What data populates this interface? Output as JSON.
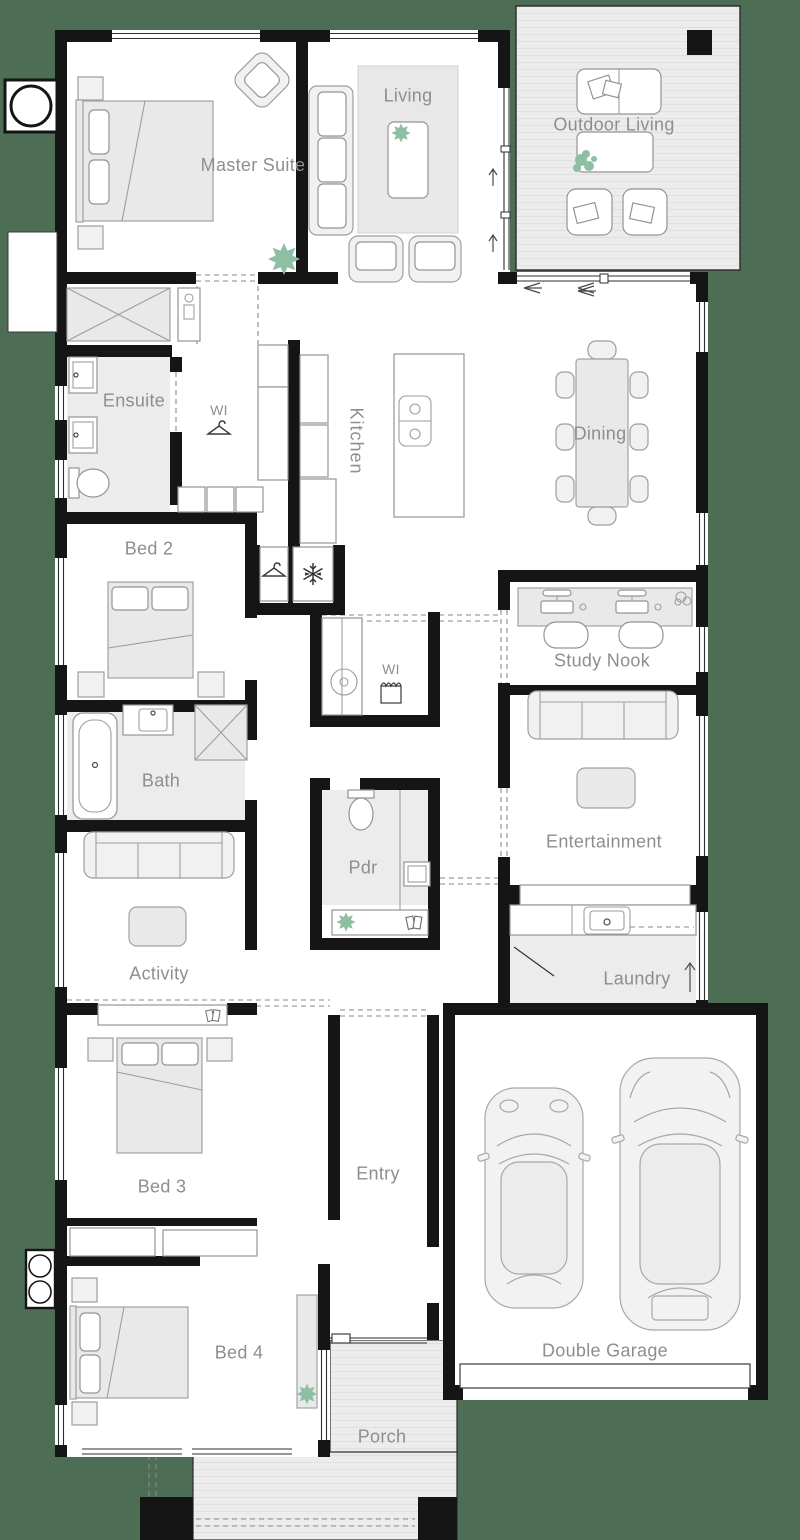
{
  "plan": {
    "type": "house-floor-plan",
    "colors": {
      "background": "#4D6E55",
      "wall": "#151515",
      "floor": "#FFFFFF",
      "wet_area": "#ECECEC",
      "deck": "#ECECEC",
      "deck_stripe": "#E0E0E0",
      "furniture_fill": "#F1F1F1",
      "furniture_stroke": "#9E9E9E",
      "label": "#8E8E8E",
      "plant_accent": "#8FBFA3"
    },
    "rooms": [
      {
        "id": "master-suite",
        "label": "Master Suite"
      },
      {
        "id": "living",
        "label": "Living"
      },
      {
        "id": "outdoor-living",
        "label": "Outdoor Living"
      },
      {
        "id": "ensuite",
        "label": "Ensuite"
      },
      {
        "id": "wi-robe",
        "label": "WI"
      },
      {
        "id": "kitchen",
        "label": "Kitchen"
      },
      {
        "id": "dining",
        "label": "Dining"
      },
      {
        "id": "bed-2",
        "label": "Bed 2"
      },
      {
        "id": "study-nook",
        "label": "Study Nook"
      },
      {
        "id": "bath",
        "label": "Bath"
      },
      {
        "id": "entertainment",
        "label": "Entertainment"
      },
      {
        "id": "activity",
        "label": "Activity"
      },
      {
        "id": "pdr",
        "label": "Pdr"
      },
      {
        "id": "wi-linen",
        "label": "WI"
      },
      {
        "id": "laundry",
        "label": "Laundry"
      },
      {
        "id": "bed-3",
        "label": "Bed 3"
      },
      {
        "id": "entry",
        "label": "Entry"
      },
      {
        "id": "bed-4",
        "label": "Bed 4"
      },
      {
        "id": "porch",
        "label": "Porch"
      },
      {
        "id": "double-garage",
        "label": "Double Garage"
      }
    ],
    "icons": [
      "plant-icon",
      "hanger-icon",
      "snowflake-icon",
      "laundry-basket-icon",
      "books-icon",
      "door-swing-icon",
      "direction-arrow-icon"
    ]
  }
}
